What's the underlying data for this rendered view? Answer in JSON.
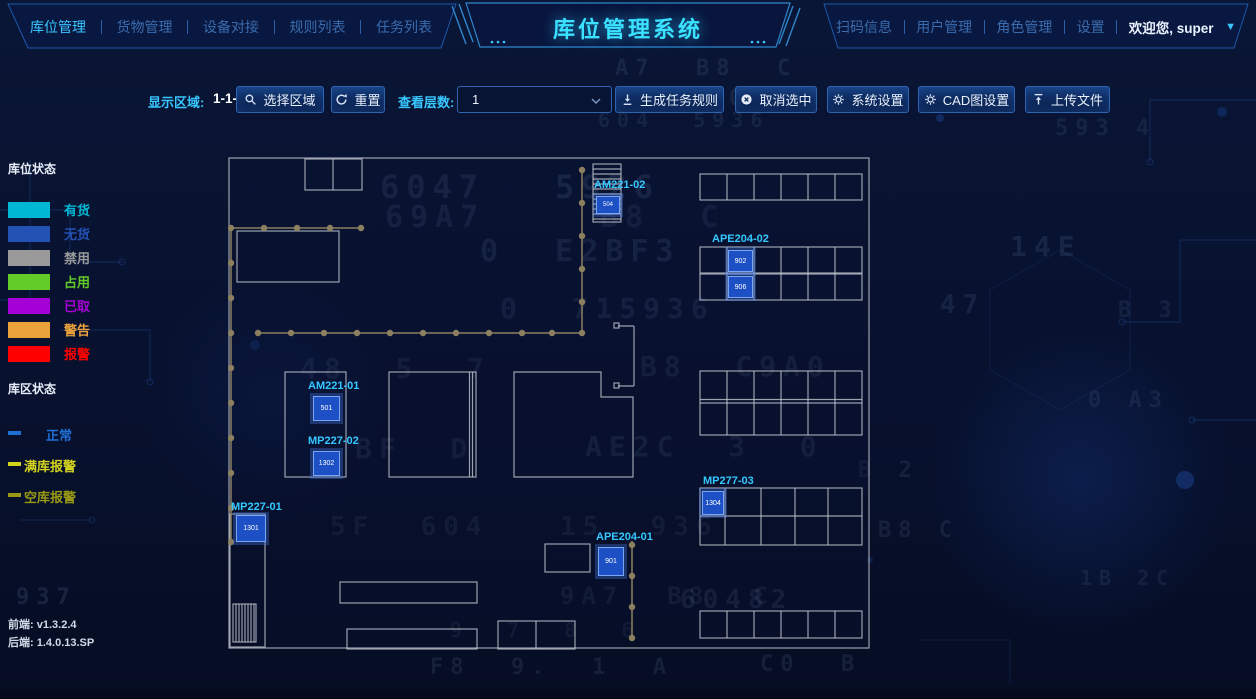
{
  "header": {
    "title": "库位管理系统",
    "nav_left": [
      {
        "label": "库位管理",
        "active": true
      },
      {
        "label": "货物管理",
        "active": false
      },
      {
        "label": "设备对接",
        "active": false
      },
      {
        "label": "规则列表",
        "active": false
      },
      {
        "label": "任务列表",
        "active": false
      }
    ],
    "nav_right": [
      {
        "label": "扫码信息"
      },
      {
        "label": "用户管理"
      },
      {
        "label": "角色管理"
      },
      {
        "label": "设置"
      }
    ],
    "welcome": "欢迎您, super"
  },
  "toolbar": {
    "display_area_label": "显示区域:",
    "display_area_value": "1-1-1",
    "select_area_button": "选择区域",
    "reset_button": "重置",
    "view_layers_label": "查看层数:",
    "view_layers_value": "1",
    "generate_task_rule_button": "生成任务规则",
    "cancel_selection_button": "取消选中",
    "system_settings_button": "系统设置",
    "cad_settings_button": "CAD图设置",
    "upload_file_button": "上传文件"
  },
  "legend": {
    "slot_status_title": "库位状态",
    "slot_statuses": [
      {
        "label": "有货",
        "color": "#00b7d4"
      },
      {
        "label": "无货",
        "color": "#2451b4"
      },
      {
        "label": "禁用",
        "color": "#9a9a9a"
      },
      {
        "label": "占用",
        "color": "#64cc28"
      },
      {
        "label": "已取",
        "color": "#a500d5"
      },
      {
        "label": "警告",
        "color": "#eca23c"
      },
      {
        "label": "报警",
        "color": "#ff0000"
      }
    ],
    "area_status_title": "库区状态",
    "area_statuses": [
      {
        "label": "正常",
        "color": "#1f6fd4"
      },
      {
        "label": "满库报警",
        "color": "#d4d41e"
      },
      {
        "label": "空库报警",
        "color": "#9a9a14"
      }
    ]
  },
  "versions": {
    "frontend_label": "前端:",
    "frontend_value": "v1.3.2.4",
    "backend_label": "后端:",
    "backend_value": "1.4.0.13.SP"
  },
  "map": {
    "devices": [
      {
        "id": "AM221-02",
        "cells": [
          "504"
        ]
      },
      {
        "id": "APE204-02",
        "cells": [
          "902",
          "906"
        ]
      },
      {
        "id": "AM221-01",
        "cells": [
          "501"
        ]
      },
      {
        "id": "MP227-02",
        "cells": [
          "1302"
        ]
      },
      {
        "id": "MP227-01",
        "cells": [
          "1301"
        ]
      },
      {
        "id": "APE204-01",
        "cells": [
          "901"
        ]
      },
      {
        "id": "MP277-03",
        "cells": [
          "1304"
        ]
      }
    ]
  },
  "colors": {
    "accent": "#38c6ff",
    "panel_border": "#1d57aa",
    "selected_cell": "#1c50c4",
    "wall": "#c2c6ce",
    "conveyor": "#8c8060"
  },
  "background_glyphs": [
    {
      "t": "A7  B8  C",
      "x": 615,
      "y": 56,
      "s": 22,
      "o": 0.1
    },
    {
      "t": "E  C0",
      "x": 648,
      "y": 86,
      "s": 22,
      "o": 0.1
    },
    {
      "t": "604  5936",
      "x": 598,
      "y": 108,
      "s": 20,
      "o": 0.09
    },
    {
      "t": "6047",
      "x": 380,
      "y": 168,
      "s": 32,
      "o": 0.13
    },
    {
      "t": "5926",
      "x": 555,
      "y": 168,
      "s": 32,
      "o": 0.15
    },
    {
      "t": "69A7",
      "x": 385,
      "y": 200,
      "s": 30,
      "o": 0.12
    },
    {
      "t": "B8  C",
      "x": 600,
      "y": 200,
      "s": 30,
      "o": 0.1
    },
    {
      "t": "0  E2BF3",
      "x": 480,
      "y": 234,
      "s": 30,
      "o": 0.13
    },
    {
      "t": "14E",
      "x": 1010,
      "y": 230,
      "s": 28,
      "o": 0.11
    },
    {
      "t": "0  715936",
      "x": 500,
      "y": 292,
      "s": 28,
      "o": 0.12
    },
    {
      "t": "47",
      "x": 940,
      "y": 290,
      "s": 26,
      "o": 0.1
    },
    {
      "t": "48  5  7",
      "x": 300,
      "y": 352,
      "s": 28,
      "o": 0.1
    },
    {
      "t": "B8  C9A0",
      "x": 640,
      "y": 350,
      "s": 28,
      "o": 0.11
    },
    {
      "t": "BF  D",
      "x": 355,
      "y": 432,
      "s": 28,
      "o": 0.11
    },
    {
      "t": "AE2C  3  0",
      "x": 585,
      "y": 430,
      "s": 28,
      "o": 0.12
    },
    {
      "t": "5F  604",
      "x": 330,
      "y": 512,
      "s": 26,
      "o": 0.1
    },
    {
      "t": "15  936",
      "x": 560,
      "y": 512,
      "s": 26,
      "o": 0.1
    },
    {
      "t": "9A7  B8  C",
      "x": 560,
      "y": 582,
      "s": 24,
      "o": 0.1
    },
    {
      "t": "937",
      "x": 16,
      "y": 585,
      "s": 22,
      "o": 0.12
    },
    {
      "t": "60482",
      "x": 680,
      "y": 585,
      "s": 26,
      "o": 0.13
    },
    {
      "t": "9  7  8  6",
      "x": 450,
      "y": 618,
      "s": 20,
      "o": 0.09
    },
    {
      "t": "F8  9.  1  A",
      "x": 430,
      "y": 655,
      "s": 22,
      "o": 0.1
    },
    {
      "t": "C0  B",
      "x": 760,
      "y": 652,
      "s": 22,
      "o": 0.1
    },
    {
      "t": "B 2",
      "x": 858,
      "y": 458,
      "s": 22,
      "o": 0.1
    },
    {
      "t": "B8 C",
      "x": 878,
      "y": 518,
      "s": 22,
      "o": 0.1
    },
    {
      "t": "0 A3",
      "x": 1088,
      "y": 388,
      "s": 22,
      "o": 0.09
    },
    {
      "t": "B 3",
      "x": 1118,
      "y": 298,
      "s": 22,
      "o": 0.09
    },
    {
      "t": "593 4",
      "x": 1055,
      "y": 116,
      "s": 22,
      "o": 0.09
    },
    {
      "t": "1B 2C",
      "x": 1080,
      "y": 566,
      "s": 20,
      "o": 0.09
    }
  ]
}
